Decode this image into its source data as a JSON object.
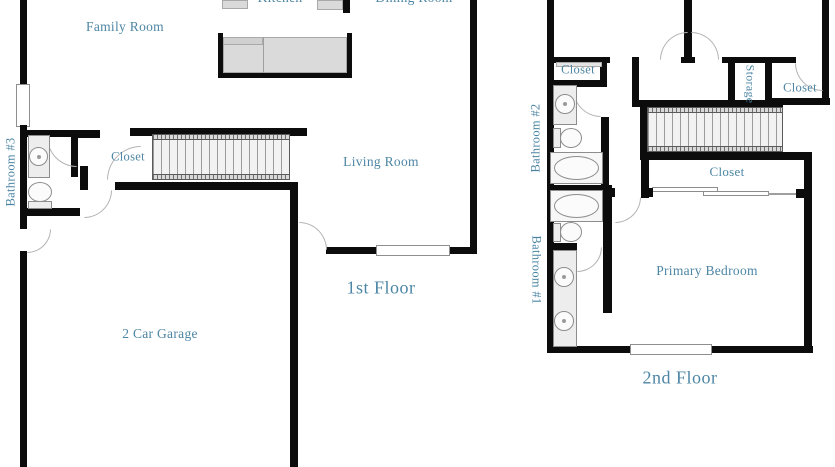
{
  "palette": {
    "background": "#ffffff",
    "wall_color": "#0c0c0c",
    "label_color": "#4d86a4",
    "door_arc_color": "#b3b3b3",
    "fixture_fill": "#ededed",
    "counter_fill": "#dadada"
  },
  "floor1": {
    "title": "1st Floor",
    "labels": {
      "family_room": "Family Room",
      "kitchen": "Kitchen",
      "dining_room": "Dining Room",
      "living_room": "Living Room",
      "closet": "Closet",
      "bathroom3": "Bathroom #3",
      "garage": "2 Car Garage"
    }
  },
  "floor2": {
    "title": "2nd Floor",
    "labels": {
      "closet_top_left": "Closet",
      "storage": "Storage",
      "closet_top_right": "Closet",
      "walk_in_closet": "Closet",
      "bathroom2": "Bathroom #2",
      "bathroom1": "Bathroom #1",
      "primary_bedroom": "Primary Bedroom"
    }
  }
}
